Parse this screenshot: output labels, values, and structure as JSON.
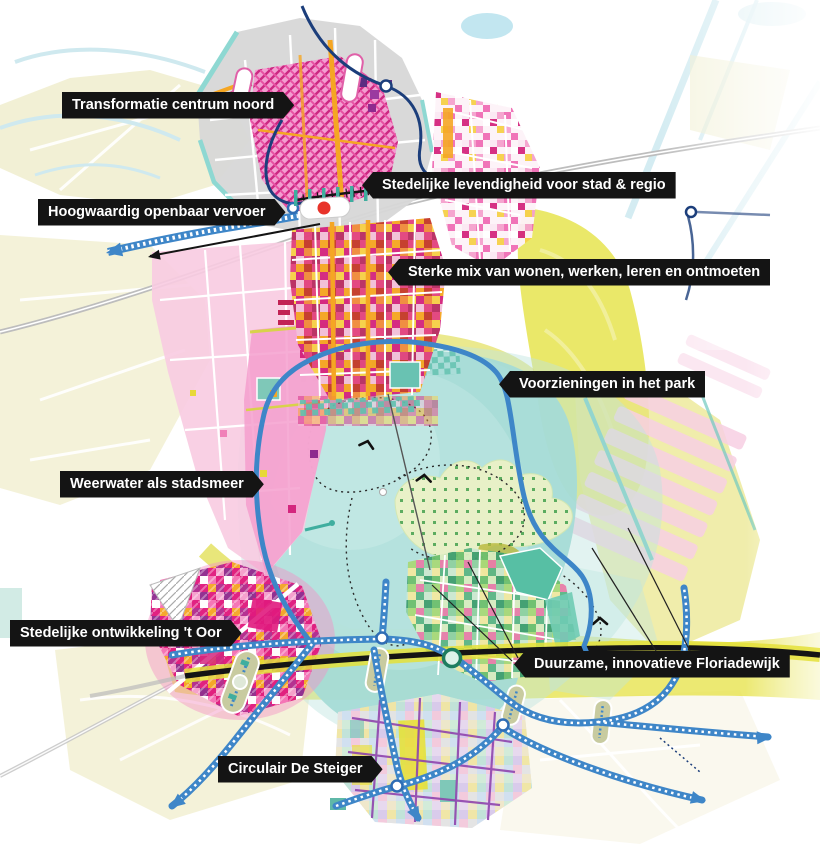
{
  "labels": [
    {
      "text": "Transformatie centrum noord",
      "direction": "right"
    },
    {
      "text": "Stedelijke levendigheid voor stad & regio",
      "direction": "left"
    },
    {
      "text": "Hoogwaardig openbaar vervoer",
      "direction": "right"
    },
    {
      "text": "Sterke mix van wonen, werken, leren en ontmoeten",
      "direction": "left"
    },
    {
      "text": "Voorzieningen in het park",
      "direction": "left"
    },
    {
      "text": "Weerwater als stadsmeer",
      "direction": "right"
    },
    {
      "text": "Stedelijke ontwikkeling 't Oor",
      "direction": "right"
    },
    {
      "text": "Duurzame, innovatieve Floriadewijk",
      "direction": "left"
    },
    {
      "text": "Circulair De Steiger",
      "direction": "right"
    }
  ],
  "colors": {
    "label_bg": "#141414",
    "label_text": "#ffffff",
    "lake_teal": "#a5dbd6",
    "lake_wash": "#bfe5e0",
    "park_yellow": "#e5e243",
    "route_blue": "#3e86c8",
    "rail_navy": "#1c3e7b",
    "urban_magenta": "#e0197d",
    "highway_black": "#141414",
    "context_cream": "#efeccb",
    "water_line": "#cfe9ef",
    "rail_gray": "#bdbdbd",
    "station_red": "#e8332a"
  },
  "icons": {
    "station": "station-marker-icon",
    "node": "route-node-icon",
    "bridge": "bridge-icon",
    "arrow": "direction-arrow-icon",
    "boat": "boat-arrow-icon"
  }
}
